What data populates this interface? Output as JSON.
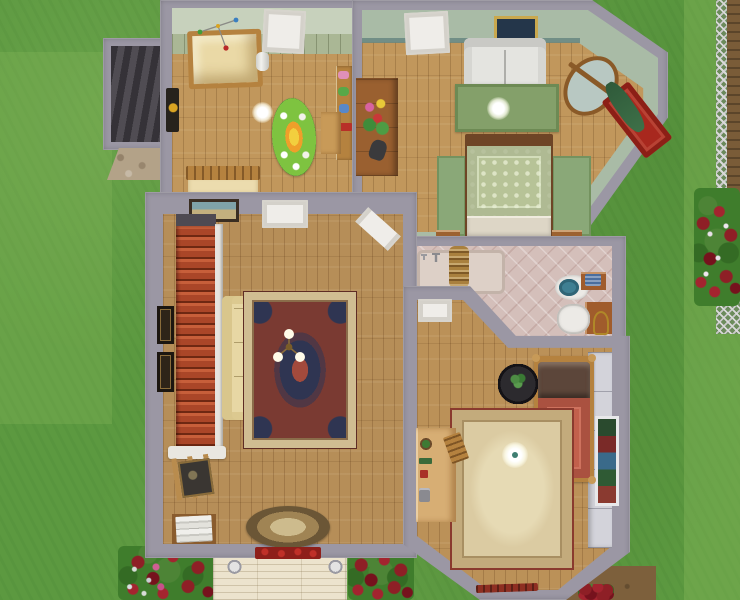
{
  "scene": {
    "type": "life-simulation game, overhead floor-plan view of a house upper storey",
    "rooms": [
      {
        "name": "nursery",
        "wall_finish": "pale green panelled wainscot",
        "floor": "light wood planks",
        "objects": [
          "wooden crib with yellow bedding",
          "baby mobile",
          "white diaper pail",
          "oval sunflower rug with bunnies",
          "toy shelf with toys",
          "small wood desk",
          "slatted wooden bench",
          "white door",
          "round ceiling lamp",
          "dark wall hanging"
        ]
      },
      {
        "name": "master-bedroom",
        "wall_finish": "sage green with teal trim",
        "floor": "light wood planks",
        "objects": [
          "white loveseat",
          "green area rug",
          "double bed with green damask cover",
          "two green bedside rugs",
          "two wooden nightstands",
          "wooden dresser with flower vase",
          "cheval mirror",
          "red wall shelf with green drape",
          "framed picture",
          "white door",
          "round ceiling lamp"
        ]
      },
      {
        "name": "bathroom",
        "wall_finish": "grey",
        "floor": "pink diamond tile",
        "objects": [
          "wall faucet",
          "turned wooden column",
          "toilet with teal seat",
          "wood cabinet with blue towels",
          "sink with wood counter",
          "brass towel stand",
          "white door (diagonal wall)"
        ]
      },
      {
        "name": "living-room",
        "wall_finish": "grey",
        "floor": "wood planks",
        "objects": [
          "red staircase with white banister",
          "cream sofa",
          "persian rug",
          "three-arm brass chandelier",
          "artist easel with canvas",
          "stack of books on shelf",
          "oval braided rug",
          "two framed pictures on left wall",
          "framed picture on top wall",
          "white door",
          "angled white door"
        ]
      },
      {
        "name": "bedroom",
        "wall_finish": "grey with white panelled closets",
        "floor": "wood planks",
        "objects": [
          "single bed with red cover and brown blanket",
          "round black table with plant",
          "beige bordered rug",
          "light wood desk with cactus and phone",
          "wooden chair",
          "framed window art",
          "round ceiling lamp",
          "white door",
          "red floor toy"
        ]
      },
      {
        "name": "attic-stairwell",
        "objects": [
          "dark descending stairs",
          "stone chimney"
        ]
      }
    ],
    "exterior": [
      "lawn",
      "lighter mown strips",
      "dark red flower beds",
      "pink and white flowers",
      "lattice fence with dirt border",
      "front porch roof with two round lamps",
      "red flower window box",
      "dirt path",
      "stone chimney"
    ]
  },
  "palette": {
    "grass": "#5c9940",
    "grassLight": "#79ad55",
    "wall": "#9b97a4",
    "wallLight": "#b6b2be",
    "woodLight": "#c1975c",
    "woodMid": "#b68e58",
    "sageWall": "#a9bba6",
    "tealTrim": "#63837e",
    "nurseryWall": "#c7d1bc",
    "wainscot": "#aab795",
    "tile": "#d4bfba",
    "stairRed": "#b24a2c",
    "sofaCream": "#e7d7a4",
    "rugRedField": "#7a3a32",
    "rugBorderCream": "#d0bd92",
    "bedGreen": "#b7c397",
    "bedRed": "#c2604c",
    "pillowBrown": "#5c463a",
    "rugBeige": "#dbcba2",
    "rugBeigeBorder": "#c3ab7c",
    "porch": "#ece3cd",
    "flowerRed": "#8e1f26",
    "foliage": "#3f7d2c",
    "white": "#efede9",
    "dirt": "#7a5c38",
    "darkStair": "#47434a",
    "stone": "#b3a288",
    "deskWood": "#d7ae74",
    "shelfWood": "#b5823f",
    "black": "#232124"
  }
}
